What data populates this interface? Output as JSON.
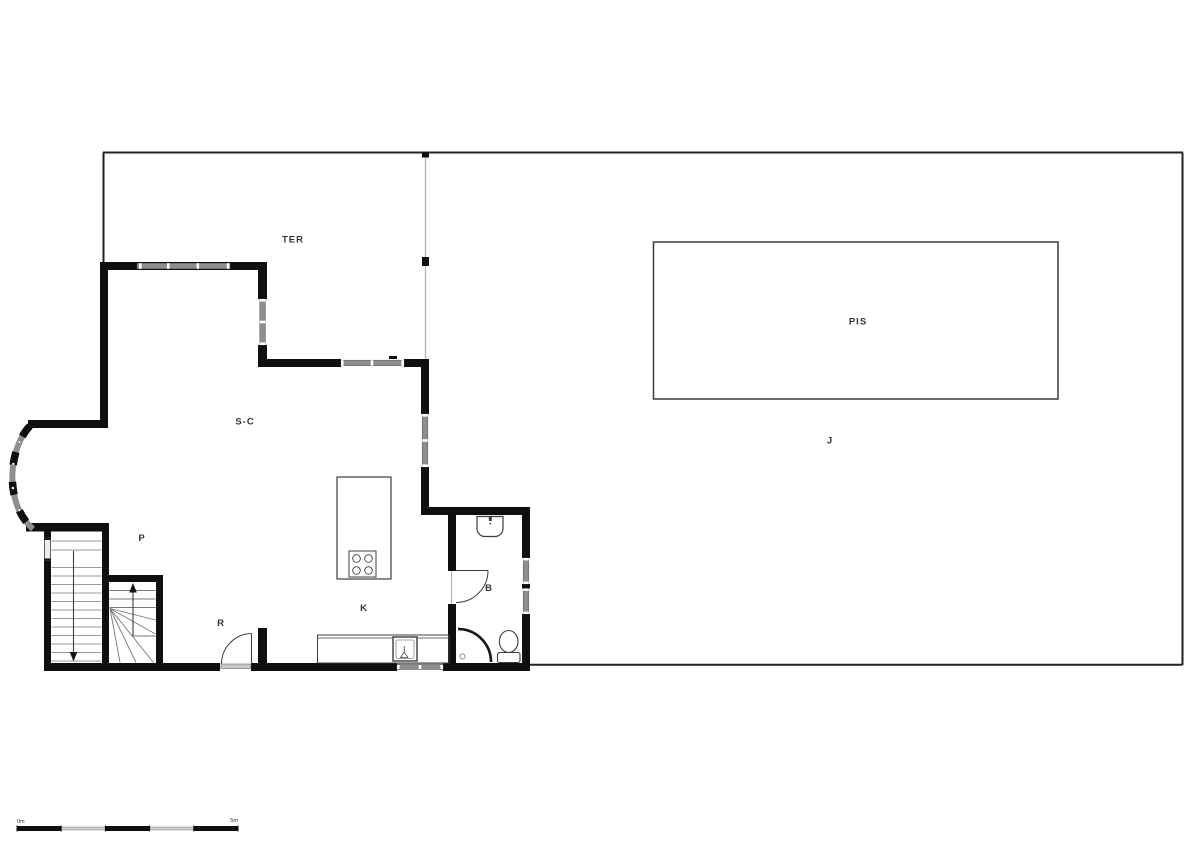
{
  "plan": {
    "labels": {
      "terrace": "TER",
      "living_dining": "S-C",
      "landing": "P",
      "hall": "R",
      "kitchen": "K",
      "bathroom": "B",
      "pool": "PIS",
      "garden": "J"
    },
    "scale_bar": {
      "start_label": "0m",
      "end_label": "5m"
    },
    "colors": {
      "wall": "#0f0f0f",
      "window_glass": "#8e8e8e",
      "boundary": "#222222",
      "divider": "#b5b5b5",
      "fixture_stroke": "#3d3d3d",
      "stair_tread": "#9a9a9a",
      "pool_border": "#3a3a3a",
      "label_text": "#333333",
      "background": "#ffffff"
    }
  }
}
